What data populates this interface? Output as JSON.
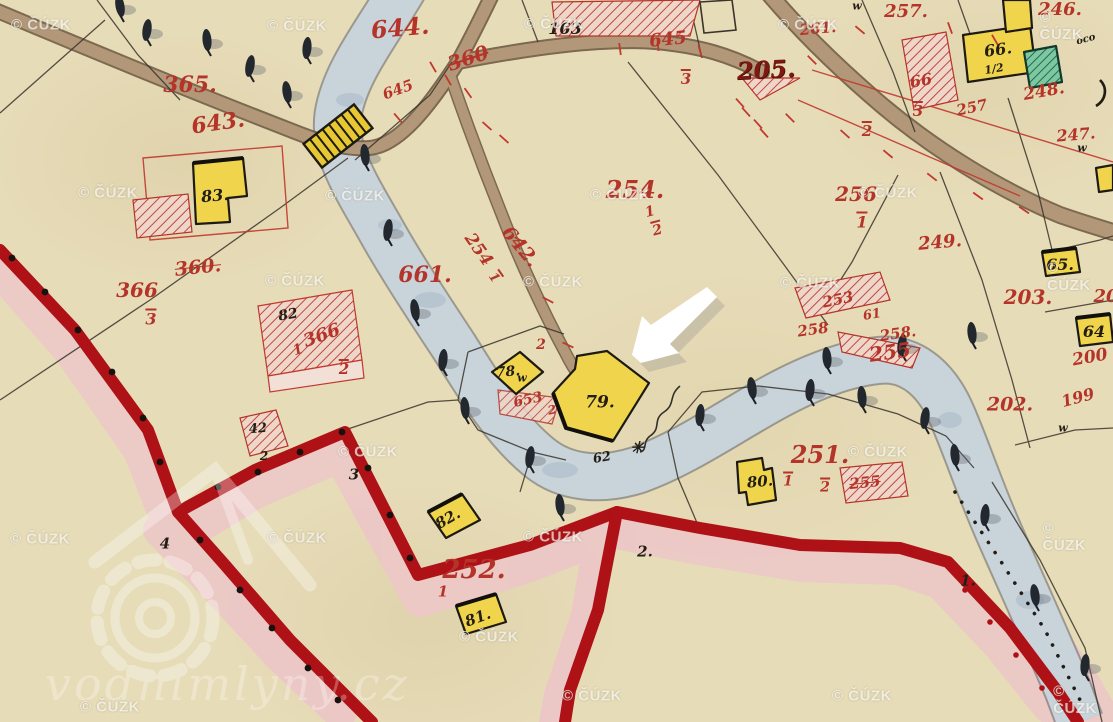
{
  "map": {
    "title": "Historical hand-drawn cadastral map scan with arrow marker",
    "watermark": {
      "text": "© ČÚZK",
      "positions": [
        [
          41,
          25
        ],
        [
          297,
          26
        ],
        [
          554,
          24
        ],
        [
          808,
          25
        ],
        [
          1064,
          26
        ],
        [
          108,
          193
        ],
        [
          355,
          196
        ],
        [
          620,
          195
        ],
        [
          888,
          193
        ],
        [
          295,
          281
        ],
        [
          553,
          282
        ],
        [
          810,
          283
        ],
        [
          1069,
          277
        ],
        [
          40,
          539
        ],
        [
          297,
          538
        ],
        [
          553,
          537
        ],
        [
          368,
          452
        ],
        [
          878,
          452
        ],
        [
          1066,
          537
        ],
        [
          489,
          637
        ],
        [
          110,
          707
        ],
        [
          592,
          696
        ],
        [
          862,
          696
        ],
        [
          1075,
          700
        ]
      ]
    },
    "logo": {
      "text": "vodnimlyny.cz"
    },
    "arrow": {
      "points_at": "building 79",
      "color": "#ffffff"
    },
    "labels": [
      {
        "t": "365.",
        "x": 190,
        "y": 85,
        "s": 22,
        "c": "red",
        "n": "parcel-number"
      },
      {
        "t": "643.",
        "x": 218,
        "y": 123,
        "s": 22,
        "c": "red",
        "r": -8,
        "n": "parcel-number"
      },
      {
        "t": "644.",
        "x": 400,
        "y": 28,
        "s": 24,
        "c": "red",
        "r": -5,
        "n": "parcel-number"
      },
      {
        "t": "360",
        "x": 468,
        "y": 58,
        "s": 20,
        "c": "red",
        "r": -18,
        "strike": true,
        "n": "parcel-number"
      },
      {
        "t": "645",
        "x": 398,
        "y": 90,
        "s": 15,
        "c": "red",
        "r": -20,
        "n": "parcel-number"
      },
      {
        "t": "645",
        "x": 668,
        "y": 40,
        "s": 18,
        "c": "red",
        "r": -6,
        "n": "parcel-number"
      },
      {
        "t": "3",
        "x": 686,
        "y": 78,
        "s": 15,
        "c": "red",
        "bar": true,
        "n": "parcel-subnumber"
      },
      {
        "t": "205.",
        "x": 766,
        "y": 70,
        "s": 24,
        "c": "redbold",
        "r": -3,
        "n": "parcel-number"
      },
      {
        "t": "257.",
        "x": 906,
        "y": 12,
        "s": 18,
        "c": "red",
        "n": "parcel-number"
      },
      {
        "t": "246.",
        "x": 1060,
        "y": 10,
        "s": 18,
        "c": "red",
        "n": "parcel-number"
      },
      {
        "t": "261.",
        "x": 818,
        "y": 29,
        "s": 15,
        "c": "red",
        "r": -5,
        "n": "parcel-number"
      },
      {
        "t": "66",
        "x": 921,
        "y": 81,
        "s": 16,
        "c": "red",
        "r": -10,
        "n": "parcel-number"
      },
      {
        "t": "3",
        "x": 918,
        "y": 110,
        "s": 15,
        "c": "red",
        "bar": true,
        "n": "parcel-subnumber"
      },
      {
        "t": "257",
        "x": 972,
        "y": 108,
        "s": 15,
        "c": "red",
        "r": -12,
        "n": "parcel-number"
      },
      {
        "t": "248.",
        "x": 1044,
        "y": 92,
        "s": 17,
        "c": "red",
        "r": -10,
        "n": "parcel-number"
      },
      {
        "t": "247.",
        "x": 1076,
        "y": 135,
        "s": 16,
        "c": "red",
        "r": -5,
        "n": "parcel-number"
      },
      {
        "t": "2",
        "x": 867,
        "y": 130,
        "s": 15,
        "c": "red",
        "bar": true,
        "n": "parcel-subnumber"
      },
      {
        "t": "256",
        "x": 856,
        "y": 194,
        "s": 20,
        "c": "red",
        "n": "parcel-number"
      },
      {
        "t": "1",
        "x": 862,
        "y": 221,
        "s": 16,
        "c": "red",
        "bar": true,
        "n": "parcel-subnumber"
      },
      {
        "t": "249.",
        "x": 940,
        "y": 243,
        "s": 18,
        "c": "red",
        "r": -5,
        "n": "parcel-number"
      },
      {
        "t": "203.",
        "x": 1028,
        "y": 297,
        "s": 20,
        "c": "red",
        "n": "parcel-number"
      },
      {
        "t": "20",
        "x": 1106,
        "y": 297,
        "s": 18,
        "c": "red",
        "n": "parcel-number"
      },
      {
        "t": "253",
        "x": 838,
        "y": 300,
        "s": 15,
        "c": "red",
        "r": -12,
        "n": "parcel-number"
      },
      {
        "t": "61",
        "x": 872,
        "y": 315,
        "s": 13,
        "c": "red",
        "r": -10,
        "n": "parcel-number"
      },
      {
        "t": "258",
        "x": 813,
        "y": 330,
        "s": 15,
        "c": "red",
        "r": -8,
        "n": "parcel-number"
      },
      {
        "t": "258.",
        "x": 898,
        "y": 334,
        "s": 15,
        "c": "red",
        "r": -8,
        "n": "parcel-number"
      },
      {
        "t": "255",
        "x": 890,
        "y": 352,
        "s": 20,
        "c": "red",
        "r": -8,
        "n": "parcel-number"
      },
      {
        "t": "202.",
        "x": 1010,
        "y": 405,
        "s": 19,
        "c": "red",
        "n": "parcel-number"
      },
      {
        "t": "199",
        "x": 1078,
        "y": 398,
        "s": 16,
        "c": "red",
        "r": -15,
        "n": "parcel-number"
      },
      {
        "t": "200",
        "x": 1090,
        "y": 358,
        "s": 17,
        "c": "red",
        "r": -10,
        "n": "parcel-number"
      },
      {
        "t": "254.",
        "x": 635,
        "y": 190,
        "s": 24,
        "c": "red",
        "n": "parcel-number"
      },
      {
        "t": "1",
        "x": 650,
        "y": 212,
        "s": 14,
        "c": "red",
        "r": -15,
        "n": "parcel-subnumber"
      },
      {
        "t": "2",
        "x": 657,
        "y": 229,
        "s": 14,
        "c": "red",
        "r": -15,
        "bar": true,
        "n": "parcel-subnumber"
      },
      {
        "t": "661.",
        "x": 425,
        "y": 275,
        "s": 22,
        "c": "red",
        "n": "parcel-number"
      },
      {
        "t": "642.",
        "x": 520,
        "y": 247,
        "s": 19,
        "c": "red",
        "r": 50,
        "n": "parcel-number"
      },
      {
        "t": "254",
        "x": 478,
        "y": 250,
        "s": 17,
        "c": "red",
        "r": 55,
        "n": "parcel-number"
      },
      {
        "t": "1",
        "x": 495,
        "y": 277,
        "s": 13,
        "c": "red",
        "r": 55,
        "bar": true,
        "n": "parcel-subnumber"
      },
      {
        "t": "366",
        "x": 137,
        "y": 290,
        "s": 20,
        "c": "red",
        "n": "parcel-number"
      },
      {
        "t": "3",
        "x": 151,
        "y": 318,
        "s": 16,
        "c": "red",
        "bar": true,
        "n": "parcel-subnumber"
      },
      {
        "t": "360.",
        "x": 198,
        "y": 268,
        "s": 19,
        "c": "red",
        "r": -6,
        "strike": true,
        "n": "parcel-number"
      },
      {
        "t": "366",
        "x": 322,
        "y": 336,
        "s": 18,
        "c": "red",
        "r": -20,
        "n": "parcel-number"
      },
      {
        "t": "1",
        "x": 298,
        "y": 350,
        "s": 14,
        "c": "red",
        "r": -20,
        "n": "parcel-subnumber"
      },
      {
        "t": "2",
        "x": 344,
        "y": 368,
        "s": 15,
        "c": "red",
        "bar": true,
        "n": "parcel-subnumber"
      },
      {
        "t": "251.",
        "x": 820,
        "y": 455,
        "s": 24,
        "c": "red",
        "n": "parcel-number"
      },
      {
        "t": "1",
        "x": 788,
        "y": 480,
        "s": 14,
        "c": "red",
        "bar": true,
        "n": "parcel-subnumber"
      },
      {
        "t": "2",
        "x": 825,
        "y": 486,
        "s": 14,
        "c": "red",
        "bar": true,
        "n": "parcel-subnumber"
      },
      {
        "t": "255",
        "x": 865,
        "y": 483,
        "s": 15,
        "c": "red",
        "r": -6,
        "strike": true,
        "n": "parcel-number"
      },
      {
        "t": "252.",
        "x": 474,
        "y": 570,
        "s": 26,
        "c": "red",
        "n": "parcel-number"
      },
      {
        "t": "1",
        "x": 443,
        "y": 592,
        "s": 15,
        "c": "red",
        "n": "parcel-subnumber"
      },
      {
        "t": "653",
        "x": 528,
        "y": 400,
        "s": 14,
        "c": "red",
        "r": -12,
        "n": "parcel-number"
      },
      {
        "t": "2",
        "x": 552,
        "y": 410,
        "s": 12,
        "c": "red",
        "r": -12,
        "n": "parcel-subnumber"
      },
      {
        "t": "2",
        "x": 541,
        "y": 345,
        "s": 14,
        "c": "red",
        "n": "parcel-subnumber"
      },
      {
        "t": "163",
        "x": 565,
        "y": 29,
        "s": 16,
        "c": "black",
        "n": "building-number"
      },
      {
        "t": "83.",
        "x": 215,
        "y": 196,
        "s": 16,
        "c": "black",
        "r": -5,
        "n": "building-number"
      },
      {
        "t": "66.",
        "x": 998,
        "y": 50,
        "s": 16,
        "c": "black",
        "r": -8,
        "n": "building-number"
      },
      {
        "t": "1/2",
        "x": 994,
        "y": 69,
        "s": 11,
        "c": "black",
        "r": -10,
        "n": "building-subnumber"
      },
      {
        "t": "65.",
        "x": 1060,
        "y": 265,
        "s": 16,
        "c": "black",
        "n": "building-number"
      },
      {
        "t": "64",
        "x": 1094,
        "y": 332,
        "s": 16,
        "c": "black",
        "n": "building-number"
      },
      {
        "t": "78.",
        "x": 508,
        "y": 372,
        "s": 14,
        "c": "black",
        "r": -5,
        "n": "building-number"
      },
      {
        "t": "79.",
        "x": 600,
        "y": 403,
        "s": 17,
        "c": "black",
        "n": "building-number"
      },
      {
        "t": "80.",
        "x": 760,
        "y": 482,
        "s": 15,
        "c": "black",
        "r": -5,
        "n": "building-number"
      },
      {
        "t": "82.",
        "x": 448,
        "y": 519,
        "s": 15,
        "c": "black",
        "r": -30,
        "n": "building-number"
      },
      {
        "t": "81.",
        "x": 478,
        "y": 618,
        "s": 15,
        "c": "black",
        "r": -20,
        "n": "building-number"
      },
      {
        "t": "82",
        "x": 288,
        "y": 315,
        "s": 14,
        "c": "black",
        "r": -10,
        "n": "building-number"
      },
      {
        "t": "42",
        "x": 258,
        "y": 429,
        "s": 13,
        "c": "black",
        "r": -5,
        "n": "building-number"
      },
      {
        "t": "2",
        "x": 264,
        "y": 456,
        "s": 12,
        "c": "black",
        "n": "boundary-point-number"
      },
      {
        "t": "2.",
        "x": 645,
        "y": 552,
        "s": 15,
        "c": "black",
        "n": "boundary-point-number"
      },
      {
        "t": "3",
        "x": 354,
        "y": 475,
        "s": 15,
        "c": "black",
        "n": "boundary-point-number"
      },
      {
        "t": "4",
        "x": 165,
        "y": 544,
        "s": 15,
        "c": "black",
        "n": "boundary-point-number"
      },
      {
        "t": "1.",
        "x": 968,
        "y": 581,
        "s": 15,
        "c": "black",
        "n": "boundary-point-number"
      },
      {
        "t": "62",
        "x": 602,
        "y": 458,
        "s": 13,
        "c": "black",
        "r": -10,
        "n": "annotation"
      },
      {
        "t": "w",
        "x": 522,
        "y": 378,
        "s": 11,
        "c": "black",
        "n": "w-mark"
      },
      {
        "t": "w",
        "x": 857,
        "y": 6,
        "s": 11,
        "c": "black",
        "n": "w-mark"
      },
      {
        "t": "w",
        "x": 1082,
        "y": 148,
        "s": 11,
        "c": "black",
        "n": "w-mark"
      },
      {
        "t": "w",
        "x": 1063,
        "y": 428,
        "s": 11,
        "c": "black",
        "n": "w-mark"
      },
      {
        "t": "oco",
        "x": 1086,
        "y": 40,
        "s": 10,
        "c": "black",
        "r": -15,
        "n": "annotation"
      },
      {
        "t": "✳",
        "x": 637,
        "y": 448,
        "s": 16,
        "c": "black",
        "n": "mill-symbol"
      }
    ],
    "symbols": {
      "trees": [
        [
          120,
          6,
          -10
        ],
        [
          147,
          30,
          8
        ],
        [
          207,
          40,
          -5
        ],
        [
          250,
          66,
          10
        ],
        [
          287,
          92,
          -8
        ],
        [
          307,
          48,
          5
        ],
        [
          365,
          155,
          -6
        ],
        [
          388,
          230,
          8
        ],
        [
          415,
          310,
          -8
        ],
        [
          443,
          360,
          6
        ],
        [
          465,
          408,
          -5
        ],
        [
          530,
          457,
          8
        ],
        [
          560,
          505,
          -6
        ],
        [
          700,
          415,
          5
        ],
        [
          752,
          388,
          -8
        ],
        [
          810,
          390,
          6
        ],
        [
          862,
          397,
          -5
        ],
        [
          925,
          418,
          8
        ],
        [
          955,
          455,
          -6
        ],
        [
          985,
          515,
          5
        ],
        [
          1035,
          595,
          -8
        ],
        [
          1085,
          665,
          6
        ],
        [
          827,
          358,
          -5
        ],
        [
          902,
          345,
          8
        ],
        [
          972,
          333,
          -6
        ]
      ],
      "red_ticks": [
        [
          433,
          67,
          60
        ],
        [
          448,
          80,
          60
        ],
        [
          468,
          93,
          55
        ],
        [
          487,
          126,
          42
        ],
        [
          504,
          139,
          42
        ],
        [
          398,
          118,
          50
        ],
        [
          620,
          49,
          82
        ],
        [
          658,
          45,
          85
        ],
        [
          700,
          51,
          75
        ],
        [
          740,
          103,
          48
        ],
        [
          746,
          112,
          48
        ],
        [
          758,
          124,
          48
        ],
        [
          764,
          133,
          48
        ],
        [
          790,
          118,
          45
        ],
        [
          845,
          134,
          42
        ],
        [
          888,
          154,
          40
        ],
        [
          932,
          177,
          38
        ],
        [
          978,
          196,
          36
        ],
        [
          1024,
          210,
          34
        ],
        [
          520,
          240,
          28
        ],
        [
          548,
          300,
          28
        ],
        [
          568,
          345,
          25
        ],
        [
          860,
          30,
          40
        ],
        [
          812,
          60,
          45
        ],
        [
          950,
          28,
          70
        ],
        [
          995,
          40,
          60
        ]
      ],
      "black_dots": [
        [
          12,
          258
        ],
        [
          45,
          292
        ],
        [
          78,
          330
        ],
        [
          112,
          372
        ],
        [
          143,
          418
        ],
        [
          160,
          462
        ],
        [
          218,
          487
        ],
        [
          258,
          472
        ],
        [
          300,
          452
        ],
        [
          342,
          432
        ],
        [
          368,
          468
        ],
        [
          390,
          515
        ],
        [
          410,
          558
        ],
        [
          200,
          540
        ],
        [
          240,
          590
        ],
        [
          272,
          628
        ],
        [
          308,
          668
        ],
        [
          338,
          700
        ]
      ],
      "red_dots": [
        [
          452,
          562
        ],
        [
          492,
          553
        ],
        [
          530,
          545
        ],
        [
          570,
          532
        ],
        [
          610,
          517
        ],
        [
          650,
          520
        ],
        [
          692,
          527
        ],
        [
          736,
          536
        ],
        [
          778,
          543
        ],
        [
          822,
          547
        ],
        [
          866,
          549
        ],
        [
          910,
          551
        ],
        [
          940,
          560
        ],
        [
          965,
          590
        ],
        [
          990,
          622
        ],
        [
          1016,
          655
        ],
        [
          1042,
          688
        ],
        [
          607,
          560
        ],
        [
          596,
          610
        ],
        [
          584,
          655
        ],
        [
          572,
          698
        ]
      ]
    },
    "colors": {
      "paper": "#e7dcb8",
      "river": "#c9d4da",
      "road": "#b29879",
      "road_edge": "#6a563e",
      "red_ink": "#b5342a",
      "black_ink": "#221d15",
      "boundary_red": "#ae1116",
      "boundary_pink": "#ecc8c6",
      "building_yellow": "#f0d44c",
      "building_green": "#6fc39a",
      "hatch_red": "#c0483e",
      "bridge_yellow": "#e8c832",
      "watermark": "#f6f4ee"
    }
  }
}
